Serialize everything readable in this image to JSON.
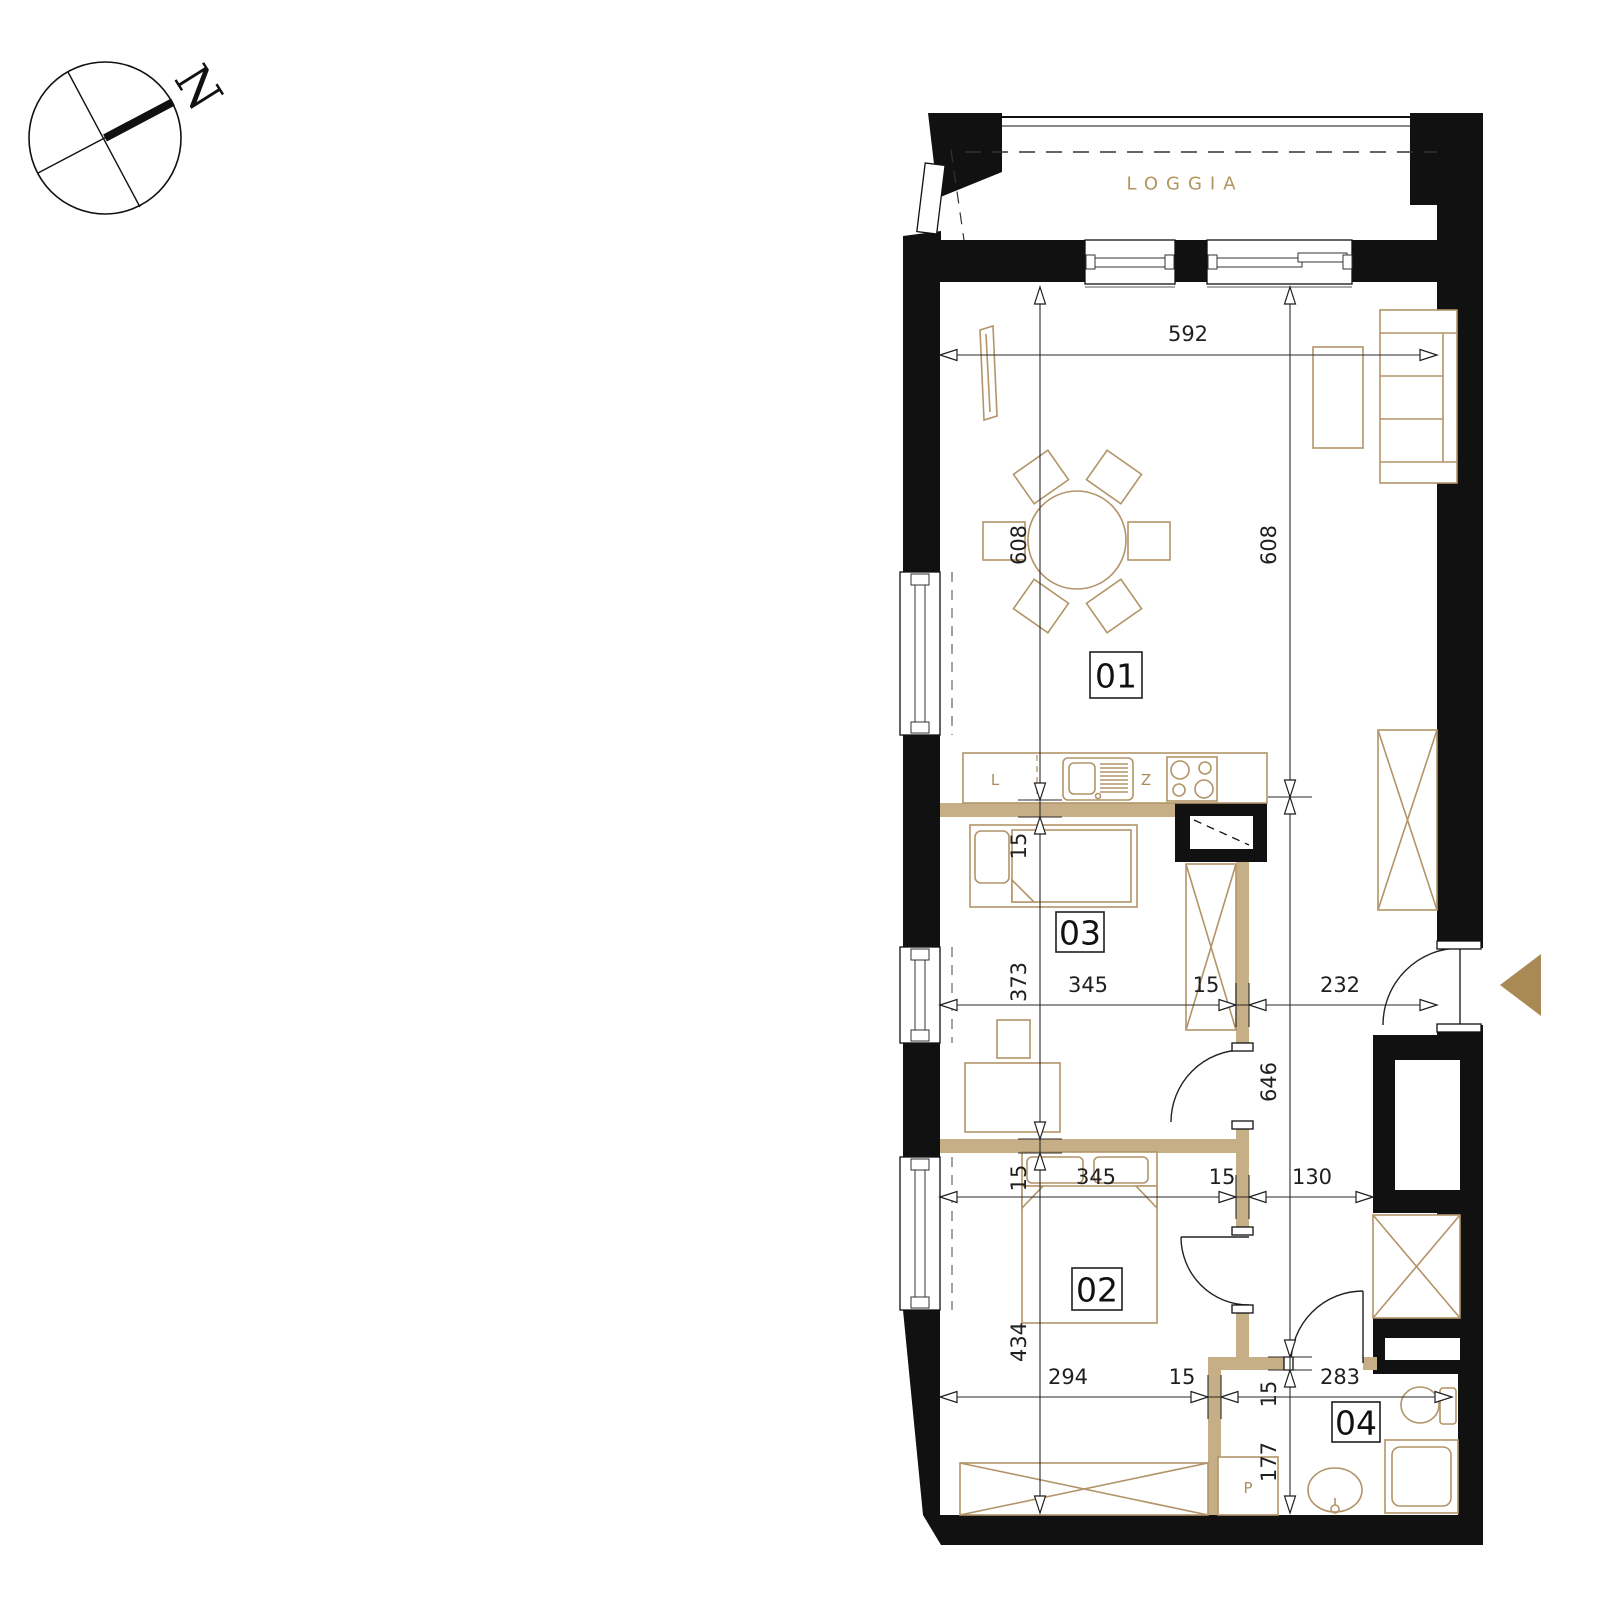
{
  "compass": {
    "north_label": "N"
  },
  "loggia": {
    "label": "LOGGIA"
  },
  "rooms": {
    "r1": "01",
    "r2": "02",
    "r3": "03",
    "r4": "04"
  },
  "fixtures": {
    "fridge": "L",
    "sink": "Z",
    "washer": "P"
  },
  "dims": {
    "w_living": "592",
    "h_left": "608",
    "h_right": "608",
    "t_kitchen_wall": "15",
    "h_room3": "373",
    "t_partition": "15",
    "h_room2": "434",
    "h_hall": "646",
    "t_bath_wall_top": "15",
    "h_bath": "177",
    "w_room3": "345",
    "t_hall_wall_upper": "15",
    "w_hall": "232",
    "w_room2": "345",
    "t_hall_wall_lower": "15",
    "w_hall_lower": "130",
    "w_room2_lower": "294",
    "t_bath_wall_left": "15",
    "w_bath": "283"
  },
  "colors": {
    "wall": "#111111",
    "partition": "#c6ae87",
    "furniture": "#b29468",
    "accent_text": "#b2945e",
    "entrance_arrow": "#a98a54",
    "dimension_text": "#1f1f1f"
  }
}
